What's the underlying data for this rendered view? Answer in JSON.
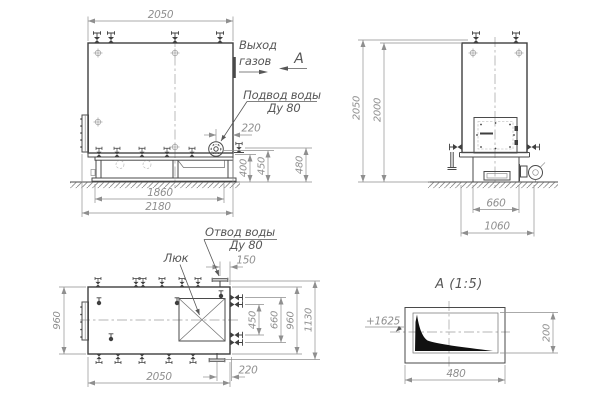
{
  "colors": {
    "outline": "#3f3f3f",
    "dimension": "#8f8f8f",
    "label": "#575757",
    "section_fill": "#111111",
    "background": "#ffffff"
  },
  "front_view": {
    "dims": {
      "width_top": "2050",
      "flange_offset": "220",
      "base_height": "400",
      "flange_height": "450",
      "valve_height": "480",
      "frame_length": "1860",
      "total_length": "2180"
    },
    "labels": {
      "gas_outlet_1": "Выход",
      "gas_outlet_2": "газов",
      "view_mark": "А",
      "water_supply_1": "Подвод воды",
      "water_supply_2": "Ду 80"
    }
  },
  "side_view": {
    "dims": {
      "total_height": "2050",
      "body_height": "2000",
      "base_width": "660",
      "overall_width": "1060"
    }
  },
  "plan_view": {
    "dims": {
      "width_left": "960",
      "drain_offset": "150",
      "nozzle_span_inner": "450",
      "nozzle_span_outer": "660",
      "width_right": "960",
      "overall_span": "1130",
      "length": "2050",
      "flange_offset": "220"
    },
    "labels": {
      "water_drain_1": "Отвод воды",
      "water_drain_2": "Ду 80",
      "manhole": "Люк"
    }
  },
  "section_a": {
    "title": "А  (1:5)",
    "level_mark": "+1625",
    "dims": {
      "opening_height": "200",
      "opening_width": "480"
    }
  }
}
